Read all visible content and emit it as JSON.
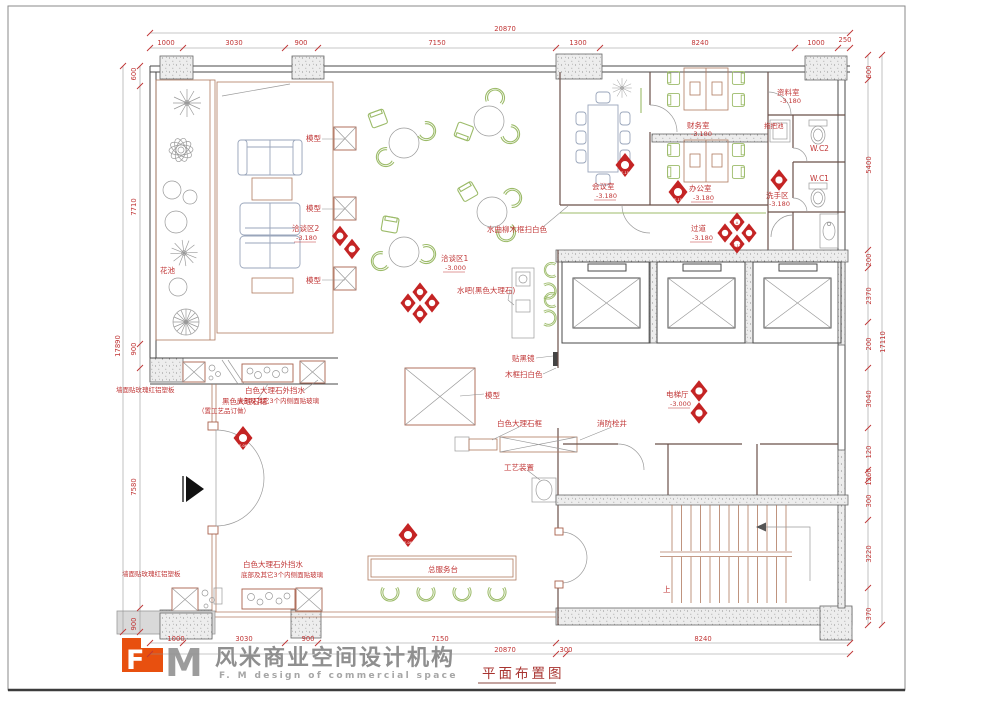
{
  "title": "平面布置图",
  "logo": {
    "mark_f": "F",
    "mark_m": "M",
    "cn": "风米商业空间设计机构",
    "en": "F. M design of commercial space",
    "orange": "#e8500f",
    "gray": "#9c9c9c"
  },
  "labels": {
    "flower_bed": "花池",
    "model": "模型",
    "negotiation2": "洽谈区2",
    "negotiation1": "洽谈区1",
    "level_3180": "-3.180",
    "level_3000": "-3.000",
    "water_bar": "水吧(黑色大理石)",
    "ash_frame": "水曲柳木框扫白色",
    "meeting": "会议室",
    "finance": "财务室",
    "office": "办公室",
    "archive": "资料室",
    "mop": "拖把池",
    "wc2": "W.C2",
    "wc1": "W.C1",
    "wash": "洗手区",
    "corridor": "过道",
    "elev_hall": "电梯厅",
    "black_mirror": "贴黑镜",
    "wood_white": "木框扫白色",
    "marble_frame": "白色大理石框",
    "hydrant": "消防栓井",
    "art": "工艺装置",
    "desk": "总服务台",
    "up": "上",
    "marble_water1": "白色大理石外挡水",
    "marble_water2": "底部及其它3个内侧面贴玻璃",
    "skirt1": "黑色大理石裙",
    "skirt2": "（置工艺品订做）",
    "wall_panel": "墙面贴玫瑰红铝塑板"
  },
  "dims": {
    "top": [
      "1000",
      "3030",
      "900",
      "7150",
      "1300",
      "8240",
      "1000",
      "250"
    ],
    "top_total": "20870",
    "bottom": [
      "1000",
      "3030",
      "900",
      "7150",
      "300",
      "8240"
    ],
    "bottom_total": "20870",
    "left": [
      "600",
      "7710",
      "900",
      "7580",
      "900"
    ],
    "left_total": "17890",
    "right": [
      "600",
      "5400",
      "200",
      "2370",
      "200",
      "3040",
      "120",
      "1260",
      "300",
      "3220",
      "370"
    ],
    "right_total": "17110"
  },
  "markers": {
    "meeting_letter": "B",
    "meeting_ref": "E-15",
    "office_letter": "A",
    "office_ref": "E-15",
    "corr_letter_a": "A",
    "corr_ref_a": "E-11",
    "corr_letter_c": "C",
    "corr_ref_c": "E-12",
    "entry_ref": "E-06",
    "desk_ref": "E-06"
  },
  "colors": {
    "cad_red": "#c03636",
    "wall": "#4a4a4a",
    "green_furniture": "#9cbb69",
    "partition": "#b07a60"
  }
}
